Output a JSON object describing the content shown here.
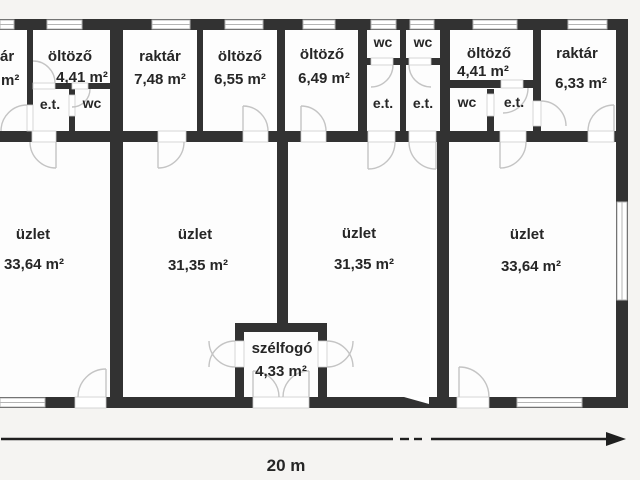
{
  "plan_type": "floor-plan",
  "dimension": {
    "label": "20 m"
  },
  "rooms": {
    "raktar_partial": {
      "name": "ár",
      "area": "m²"
    },
    "oltozo_left": {
      "name": "öltöző",
      "area": "4,41 m²"
    },
    "et_left": {
      "name": "e.t."
    },
    "wc_left": {
      "name": "wc"
    },
    "raktar_748": {
      "name": "raktár",
      "area": "7,48 m²"
    },
    "oltozo_655": {
      "name": "öltöző",
      "area": "6,55 m²"
    },
    "oltozo_649": {
      "name": "öltöző",
      "area": "6,49 m²"
    },
    "wc_mid_1": {
      "name": "wc"
    },
    "wc_mid_2": {
      "name": "wc"
    },
    "et_mid_1": {
      "name": "e.t."
    },
    "et_mid_2": {
      "name": "e.t."
    },
    "oltozo_right": {
      "name": "öltöző",
      "area": "4,41 m²"
    },
    "wc_right": {
      "name": "wc"
    },
    "et_right": {
      "name": "e.t."
    },
    "raktar_633": {
      "name": "raktár",
      "area": "6,33 m²"
    },
    "uzlet_1": {
      "name": "üzlet",
      "area": "33,64 m²"
    },
    "uzlet_2": {
      "name": "üzlet",
      "area": "31,35 m²"
    },
    "uzlet_3": {
      "name": "üzlet",
      "area": "31,35 m²"
    },
    "uzlet_4": {
      "name": "üzlet",
      "area": "33,64 m²"
    },
    "szelfogo": {
      "name": "szélfogó",
      "area": "4,33 m²"
    }
  },
  "colors": {
    "wall": "#323232",
    "text": "#262626",
    "door": "#c4c4c4",
    "dimension": "#1f1f1f",
    "room_fill": "#fdfdfd"
  }
}
